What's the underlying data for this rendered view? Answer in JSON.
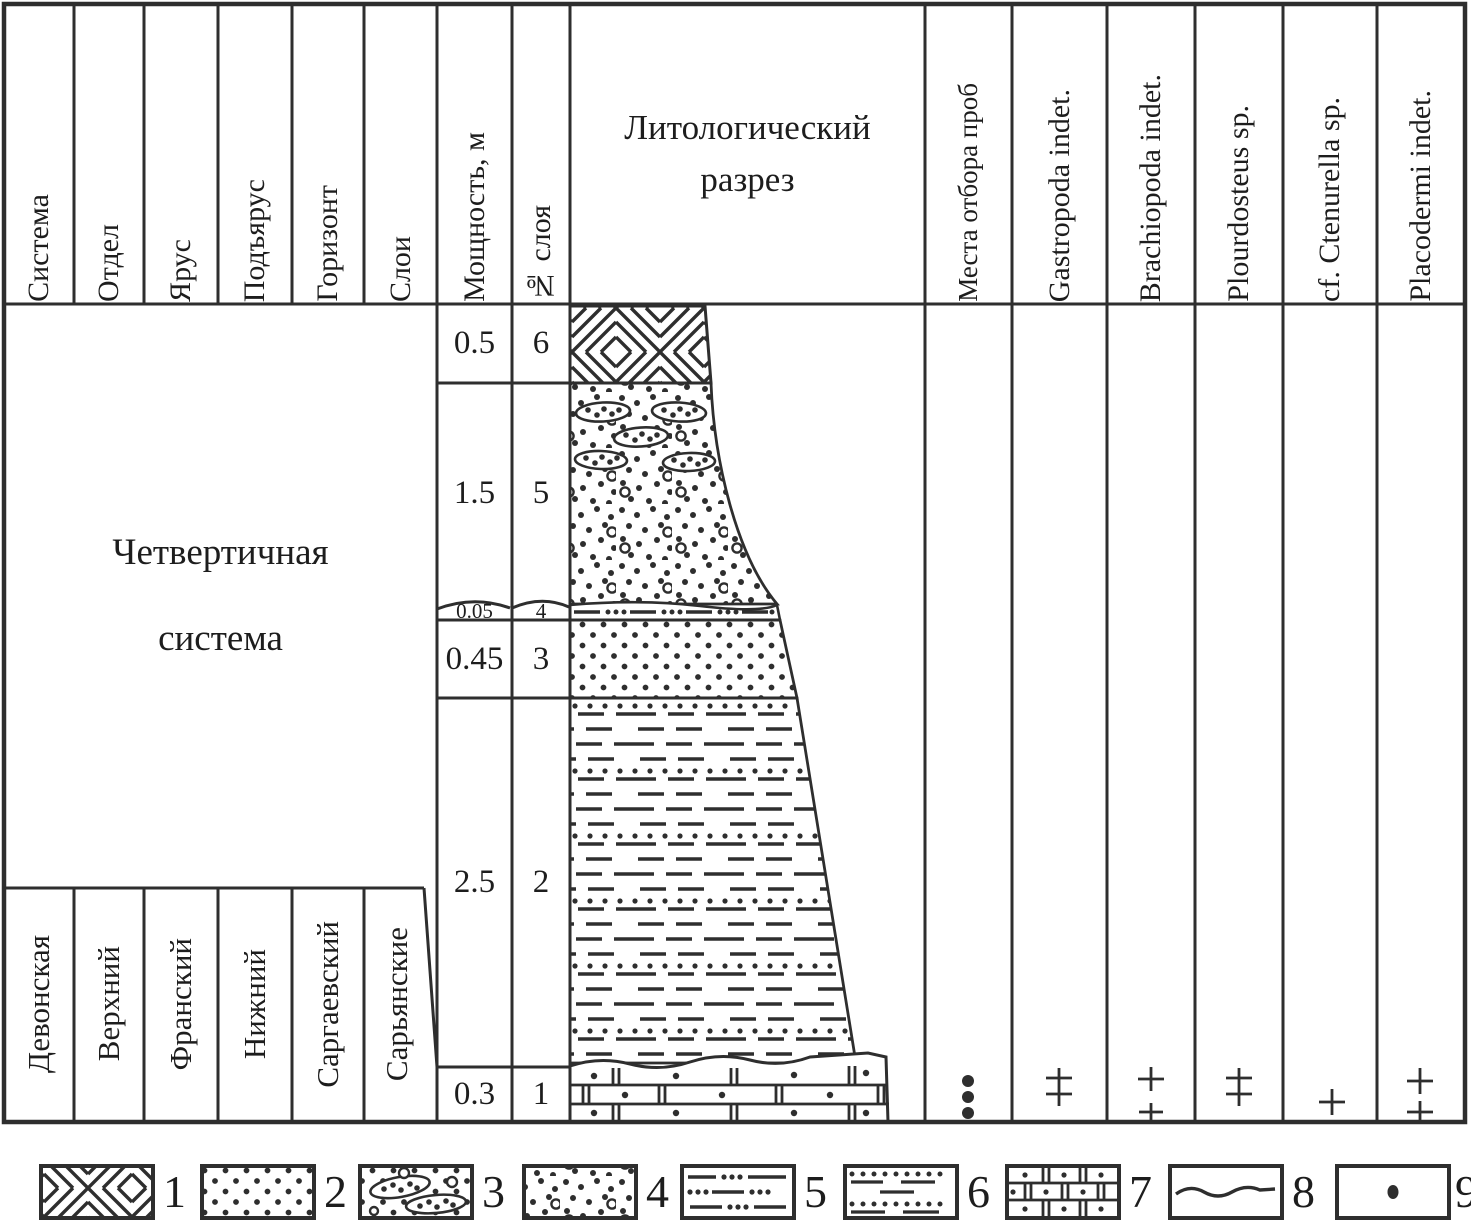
{
  "colors": {
    "ink": "#2e2e2e",
    "paper": "#ffffff"
  },
  "header": {
    "system": "Система",
    "division": "Отдел",
    "stage": "Ярус",
    "substage": "Подъярус",
    "horizon": "Горизонт",
    "beds": "Слои",
    "thickness": "Мощность, м",
    "layer_no": "№ слоя",
    "lithology": {
      "line1": "Литологический",
      "line2": "разрез"
    },
    "sampling": "Места отбора проб",
    "fossils": [
      "Gastropoda indet.",
      "Brachiopoda indet.",
      "Plourdosteus sp.",
      "cf. Ctenurella sp.",
      "Placodermi indet."
    ]
  },
  "stratigraphy": {
    "quaternary": {
      "line1": "Четвертичная",
      "line2": "система"
    },
    "devonian": {
      "system": "Девонская",
      "division": "Верхний",
      "stage": "Франский",
      "substage": "Нижний",
      "horizon": "Саргаевский",
      "beds": "Сарьянские"
    }
  },
  "layers": [
    {
      "no": "6",
      "thickness": "0.5",
      "lithology": "cross-hatch"
    },
    {
      "no": "5",
      "thickness": "1.5",
      "lithology": "sand-gravel-with-pebble-lenses"
    },
    {
      "no": "4",
      "thickness": "0.05",
      "lithology": "dash-and-dot-band"
    },
    {
      "no": "3",
      "thickness": "0.45",
      "lithology": "dotted-sand"
    },
    {
      "no": "2",
      "thickness": "2.5",
      "lithology": "dashed-clay-with-dot-lines"
    },
    {
      "no": "1",
      "thickness": "0.3",
      "lithology": "limestone-bricks-with-dots"
    }
  ],
  "occurrences": [
    {
      "column": "Места отбора проб",
      "mark": "three-filled-dots"
    },
    {
      "column": "Gastropoda indet.",
      "mark": "double-crossbar-plus"
    },
    {
      "column": "Brachiopoda indet.",
      "mark": "two-stacked-plus"
    },
    {
      "column": "Plourdosteus sp.",
      "mark": "double-crossbar-plus"
    },
    {
      "column": "cf. Ctenurella sp.",
      "mark": "single-plus"
    },
    {
      "column": "Placodermi indet.",
      "mark": "two-stacked-plus"
    }
  ],
  "legend": [
    {
      "num": "1",
      "pattern": "cross-hatch"
    },
    {
      "num": "2",
      "pattern": "dots"
    },
    {
      "num": "3",
      "pattern": "pebble-lenses-in-sand"
    },
    {
      "num": "4",
      "pattern": "dots-with-circles"
    },
    {
      "num": "5",
      "pattern": "dashes-with-dot-groups"
    },
    {
      "num": "6",
      "pattern": "dot-rows-with-dashes"
    },
    {
      "num": "7",
      "pattern": "brick-limestone-with-dots"
    },
    {
      "num": "8",
      "pattern": "wavy-line"
    },
    {
      "num": "9",
      "pattern": "single-dot"
    }
  ]
}
